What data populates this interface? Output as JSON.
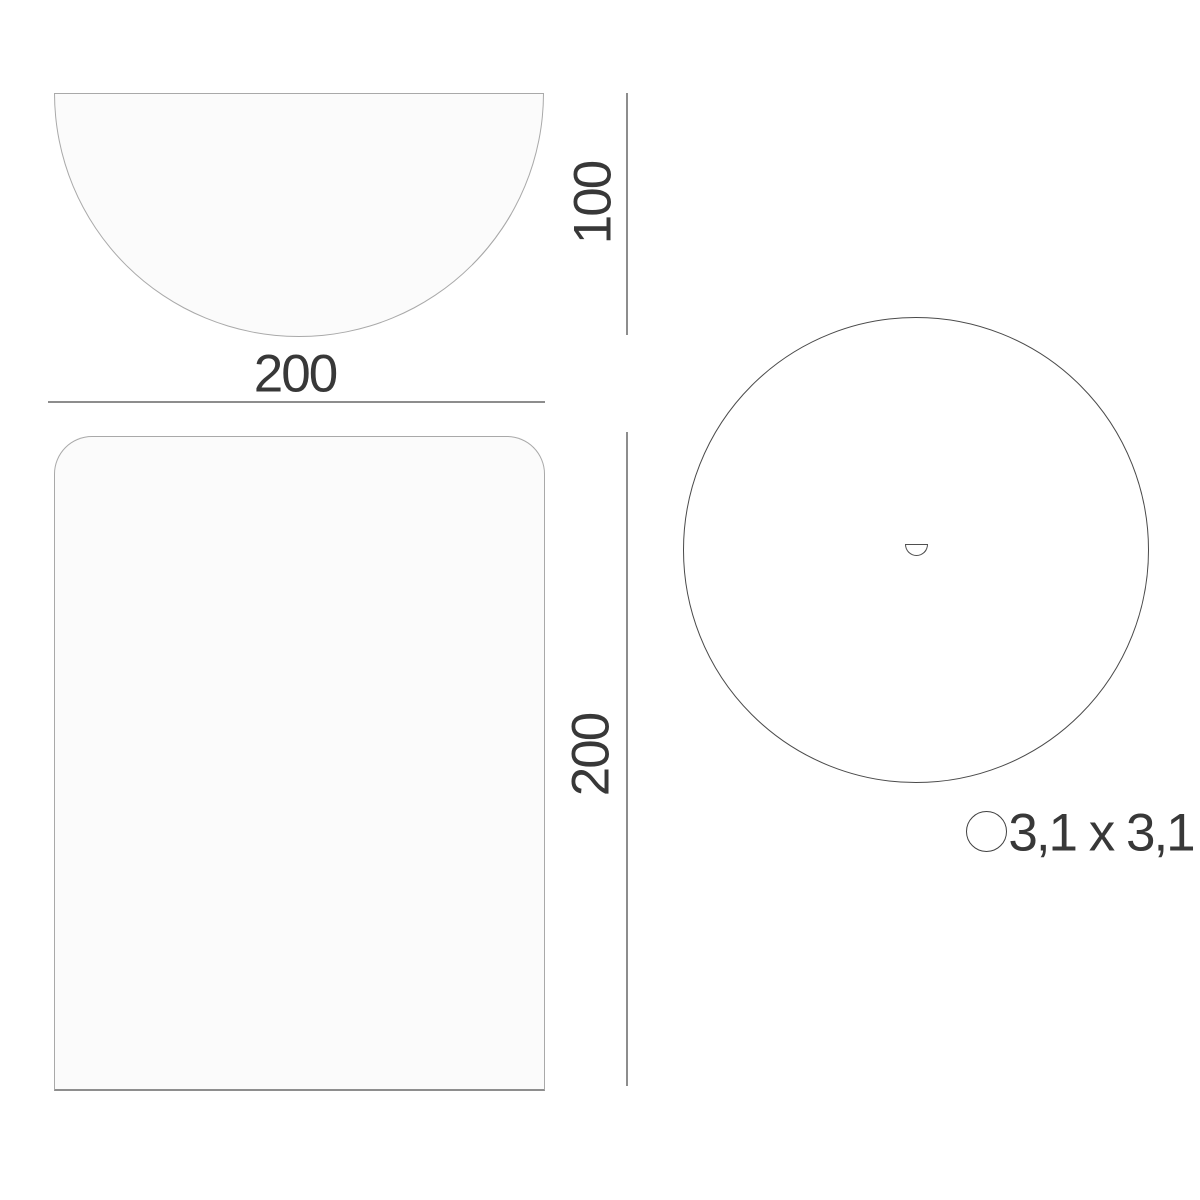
{
  "diagram": {
    "semicircle": {
      "width": "200",
      "height": "100"
    },
    "rectangle": {
      "height": "200"
    },
    "hole": {
      "size": "3,1 x 3,1"
    },
    "colors": {
      "background": "#ffffff",
      "shape_fill": "#fbfbfb",
      "shape_stroke_light": "#a9a9a9",
      "shape_stroke_dark": "#4a4a4a",
      "dimension_line": "#8d8d8d",
      "label_text": "#383838"
    }
  }
}
